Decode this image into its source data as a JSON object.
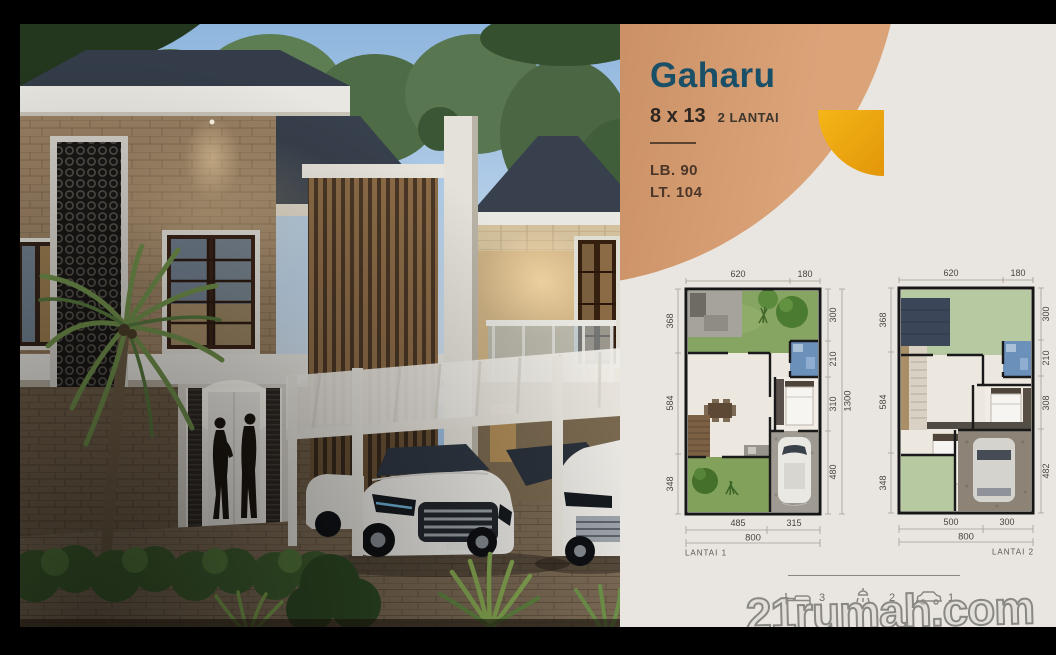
{
  "window": {
    "width": 1056,
    "height": 655,
    "frame_color": "#000000"
  },
  "panel": {
    "background": "#e9e6e2",
    "title": "Gaharu",
    "size": "8 x 13",
    "floors": "2 LANTAI",
    "building_area": "LB. 90",
    "land_area": "LT. 104",
    "title_color": "#1a4f68",
    "spec_text_color": "#4b3629",
    "circle_colors": [
      "#ad7449",
      "#dba378"
    ],
    "accent_quarter_color": "#eda60e"
  },
  "plans": [
    {
      "label": "LANTAI 1",
      "dims_top": [
        "620",
        "180"
      ],
      "dims_left": [
        "368",
        "584",
        "348"
      ],
      "dims_right": [
        "300",
        "210",
        "310",
        "480"
      ],
      "dim_total_right": "1300",
      "dims_bottom": [
        "485",
        "315"
      ],
      "dim_total_bottom": "800"
    },
    {
      "label": "LANTAI 2",
      "dims_top": [
        "620",
        "180"
      ],
      "dims_left": [
        "368",
        "584",
        "348"
      ],
      "dims_right": [
        "300",
        "210",
        "308",
        "482"
      ],
      "dims_bottom": [
        "500",
        "300"
      ],
      "dim_total_bottom": "800"
    }
  ],
  "legend": {
    "items": [
      {
        "icon": "bed-icon",
        "count": "3"
      },
      {
        "icon": "shower-icon",
        "count": "2"
      },
      {
        "icon": "car-icon",
        "count": "1"
      }
    ]
  },
  "watermark": {
    "text": "21rumah.com"
  },
  "scene": {
    "label": "Dusk 3D exterior render of two-storey modern tropical houses with stone cladding, timber louvers, white carport pergola, two white cars, palm tree and a couple at the lit entrance"
  }
}
